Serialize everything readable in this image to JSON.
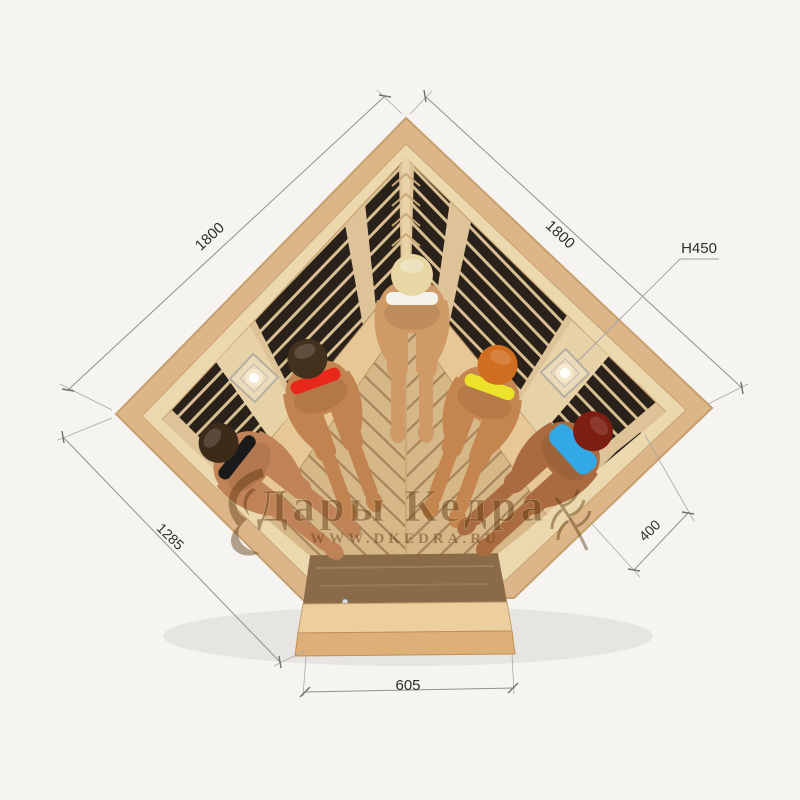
{
  "page": {
    "background": "#f5f4f1"
  },
  "watermark": {
    "brand": "Дары Кедра",
    "website": "WWW.DKEDRA.RU",
    "color": "#5e3911"
  },
  "dimensions": {
    "left_wall": {
      "label": "1800"
    },
    "right_wall": {
      "label": "1800"
    },
    "height": {
      "label": "H450"
    },
    "front_left": {
      "label": "1285"
    },
    "right_side": {
      "label": "400"
    },
    "door": {
      "label": "605"
    }
  },
  "sauna": {
    "frame_wood": "#dcb688",
    "wall_wood": "#ecd8ae",
    "band_wood": "#dfc398",
    "panel_dark": "#2a211a",
    "slat_light": "#d8bf92",
    "floor_light": "#d6b787",
    "floor_gap": "#a9835a",
    "bench_wood": "#e6c795",
    "step_wood": "#eccf9d",
    "step_face": "#ddb077",
    "glass_tint": "rgba(58,34,16,0.42)"
  },
  "people": [
    {
      "id": "woman-black-bikini",
      "hair": "#3d2b1a",
      "bikini": "#1a1a1a",
      "skin": "#c08257"
    },
    {
      "id": "woman-red-bikini",
      "hair": "#43301d",
      "bikini": "#e8281a",
      "skin": "#c1834f"
    },
    {
      "id": "woman-white-bikini",
      "hair": "#e7d7a5",
      "bikini": "#f5f2ec",
      "skin": "#cf9a66"
    },
    {
      "id": "woman-yellow-bikini",
      "hair": "#d06d1e",
      "bikini": "#eae32a",
      "skin": "#c5854f"
    },
    {
      "id": "woman-blue-bikini",
      "hair": "#7d1e12",
      "bikini": "#32a9e6",
      "skin": "#a96b3f"
    }
  ]
}
